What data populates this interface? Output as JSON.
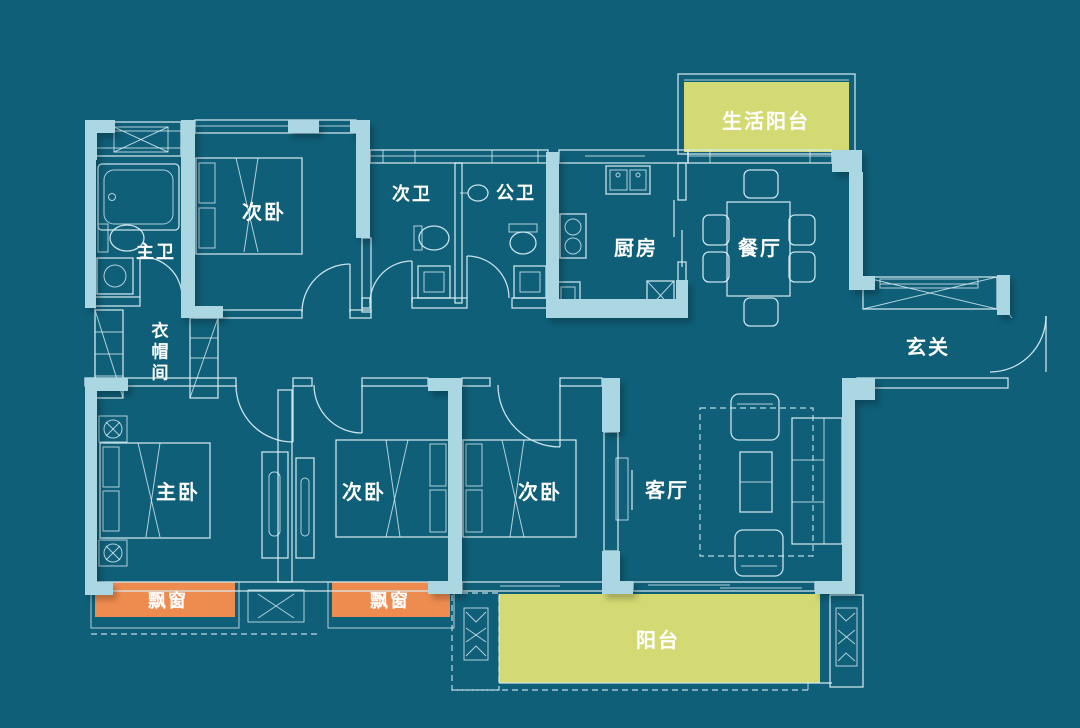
{
  "title": "apartment-floor-plan",
  "colors": {
    "background": "#0f5f78",
    "wall": "#abd7e3",
    "line": "#d9eef5",
    "balcony_fill": "#d3d973",
    "bay_window_fill": "#ee8c50",
    "label_text": "#ffffff"
  },
  "labels": {
    "master_bath": "主卫",
    "bedroom_a": "次卧",
    "cloakroom_1": "衣",
    "cloakroom_2": "帽",
    "cloakroom_3": "间",
    "bath_b": "次卫",
    "bath_public": "公卫",
    "kitchen": "厨房",
    "dining": "餐厅",
    "service_balcony": "生活阳台",
    "foyer": "玄关",
    "master_bedroom": "主卧",
    "bedroom_b": "次卧",
    "bedroom_c": "次卧",
    "living": "客厅",
    "bay_window_1": "飘窗",
    "bay_window_2": "飘窗",
    "balcony": "阳台"
  }
}
